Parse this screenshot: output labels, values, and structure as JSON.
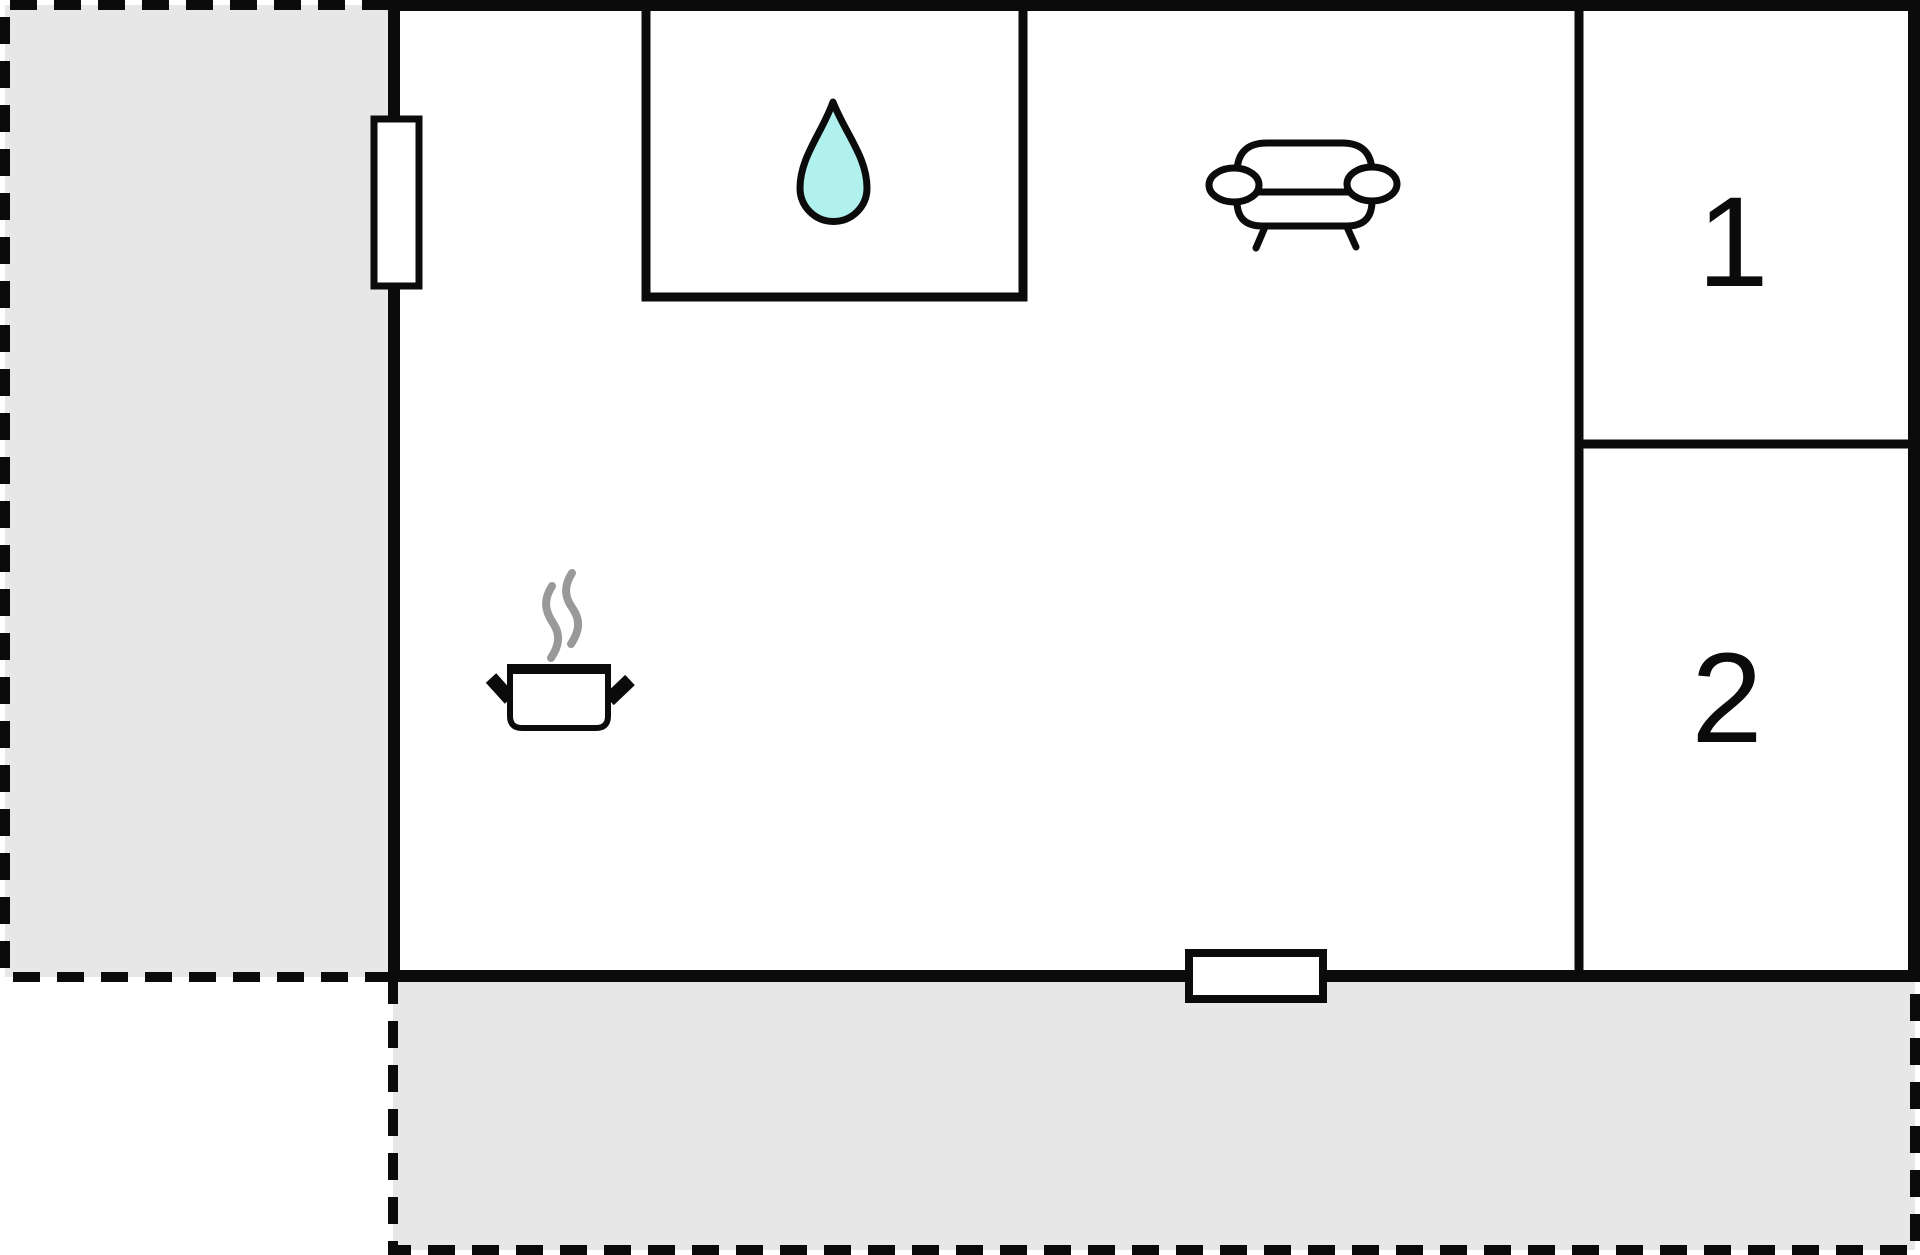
{
  "floor_plan": {
    "rooms": [
      {
        "label": "1"
      },
      {
        "label": "2"
      }
    ],
    "icons": {
      "bathroom": "water-drop-icon",
      "living_area": "sofa-icon",
      "kitchen": "cooking-pot-icon",
      "openings": [
        "window-left",
        "window-bottom"
      ]
    },
    "outdoor_areas": [
      "terrace-left",
      "terrace-bottom"
    ]
  },
  "colors": {
    "wall": "#0b0b0b",
    "outdoor_fill": "#e7e7e7",
    "interior_fill": "#ffffff",
    "drop_fill": "#b0f1ee",
    "steam": "#999999",
    "label_text": "#0b0b0b"
  }
}
